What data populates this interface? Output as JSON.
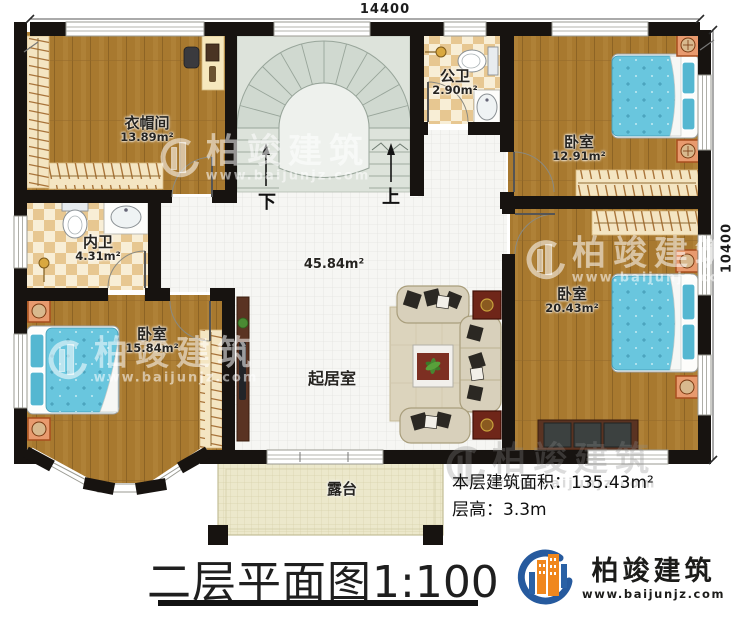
{
  "plan": {
    "title": "二层平面图",
    "scale": "1:100",
    "stats": {
      "area_label": "本层建筑面积：",
      "area_value": "135.43m²",
      "height_label": "层高：",
      "height_value": "3.3m"
    },
    "dimensions": {
      "top": "14400",
      "right": "10400"
    },
    "stairs": {
      "down": "下",
      "up": "上"
    },
    "rooms": {
      "cloakroom": {
        "name": "衣帽间",
        "area": "13.89m²"
      },
      "public_bathroom": {
        "name": "公卫",
        "area": "2.90m²"
      },
      "bedroom_top_right": {
        "name": "卧室",
        "area": "12.91m²"
      },
      "private_bathroom": {
        "name": "内卫",
        "area": "4.31m²"
      },
      "bedroom_right": {
        "name": "卧室",
        "area": "20.43m²"
      },
      "bedroom_bottom_left": {
        "name": "卧室",
        "area": "15.84m²"
      },
      "living_room": {
        "name": "起居室",
        "area": "45.84m²"
      },
      "terrace": {
        "name": "露台"
      }
    },
    "brand": {
      "name": "柏竣建筑",
      "website": "www.baijunjz.com"
    },
    "colors": {
      "wall": "#171310",
      "wood": "#a8792f",
      "bath_tile": "#e7c791",
      "stair": "#dde3db",
      "terrace": "#ece8cb",
      "bed": "#69c6de",
      "accent_blue": "#2a61a5",
      "accent_orange": "#f0871d"
    }
  }
}
